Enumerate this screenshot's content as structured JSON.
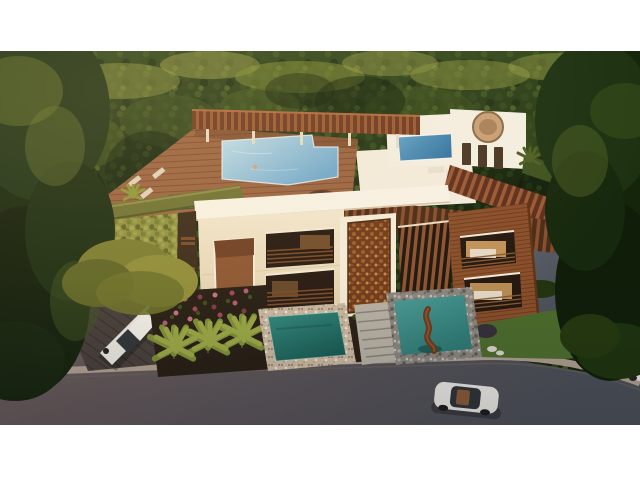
{
  "scene": {
    "description": "Aerial dusk 3D architectural rendering of a modern three-story residence surrounded by dense jungle canopy, with a rooftop swimming pool and wood pergolas, a spa pavilion, a green living wall, a carved wood entry panel, vertical wood louvers, a wood-clad wing with lit balconies, landscaped palm gardens, two teal plunge pools with a driftwood sculpture water feature, driveways, a street, a white SUV and a white sedan",
    "objects": [
      "tree-canopy",
      "rooftop-pool",
      "rooftop-pergolas",
      "sun-deck",
      "spa-pavilion",
      "roof-plunge-pool",
      "green-living-wall",
      "hedge-parapet",
      "cream-facade",
      "carved-entry-panel",
      "wood-louvers",
      "wood-clad-wing",
      "balconies",
      "garden-palms",
      "flower-bed",
      "plunge-pool",
      "stone-steps",
      "sculpture-water-feature",
      "rock-garden",
      "lawn",
      "street",
      "left-driveway",
      "right-driveway",
      "white-suv",
      "white-sedan",
      "parked-car-edge"
    ]
  },
  "colors": {
    "letterbox": "#ffffff",
    "canopy_top": "#31461d",
    "canopy_mid": "#1a2a10",
    "canopy_dark": "#121f0b",
    "canopy_sunlit": "#9aa04a",
    "roof_deck_wood": "#9a6440",
    "pergola_stripe": "#9a5a34",
    "pergola_base": "#6e3a22",
    "rooftop_pool_light": "#bfe0ec",
    "rooftop_pool_deep": "#6fa8cc",
    "roof_plunge_light": "#5fa3c9",
    "roof_plunge_deep": "#2e6f9e",
    "pavilion_white": "#f4efe2",
    "spa_bowl_tan": "#c9a076",
    "fascia_white": "#f8f3e6",
    "facade_cream_light": "#f2e7cf",
    "facade_cream_deep": "#e0cda6",
    "green_wall": "#8f9140",
    "hedge_green": "#6e7232",
    "carved_wood": "#6e3a1a",
    "louver_wood": "#8a5230",
    "siding_wood": "#8a4f2a",
    "window_dark": "#241810",
    "interior_glow": "#e8b36a",
    "plunge_pool_teal": "#2f8a80",
    "plunge_pool_teal_deep": "#175c54",
    "water_feature_teal": "#4a9a96",
    "water_feature_teal_deep": "#2e7a74",
    "pebble_border": "#cbb9a2",
    "stone_border": "#8a857e",
    "lawn_green": "#4c6c2c",
    "palm_green": "#7d8f35",
    "palm_light": "#9aa844",
    "flower_magenta": "#b0485c",
    "soil_dark": "#241c12",
    "driveway_pavers": "#453d3a",
    "driveway_gray_light": "#5e636d",
    "driveway_gray_dark": "#454a52",
    "road_warm": "#6b5a5a",
    "road_cool": "#4a4e56",
    "curb_light": "#b5a495",
    "car_white": "#eceae4",
    "car_glass": "#2e3338",
    "sculpture_wood": "#6b3a1f",
    "sunset_glow": "#ffcf8e"
  }
}
